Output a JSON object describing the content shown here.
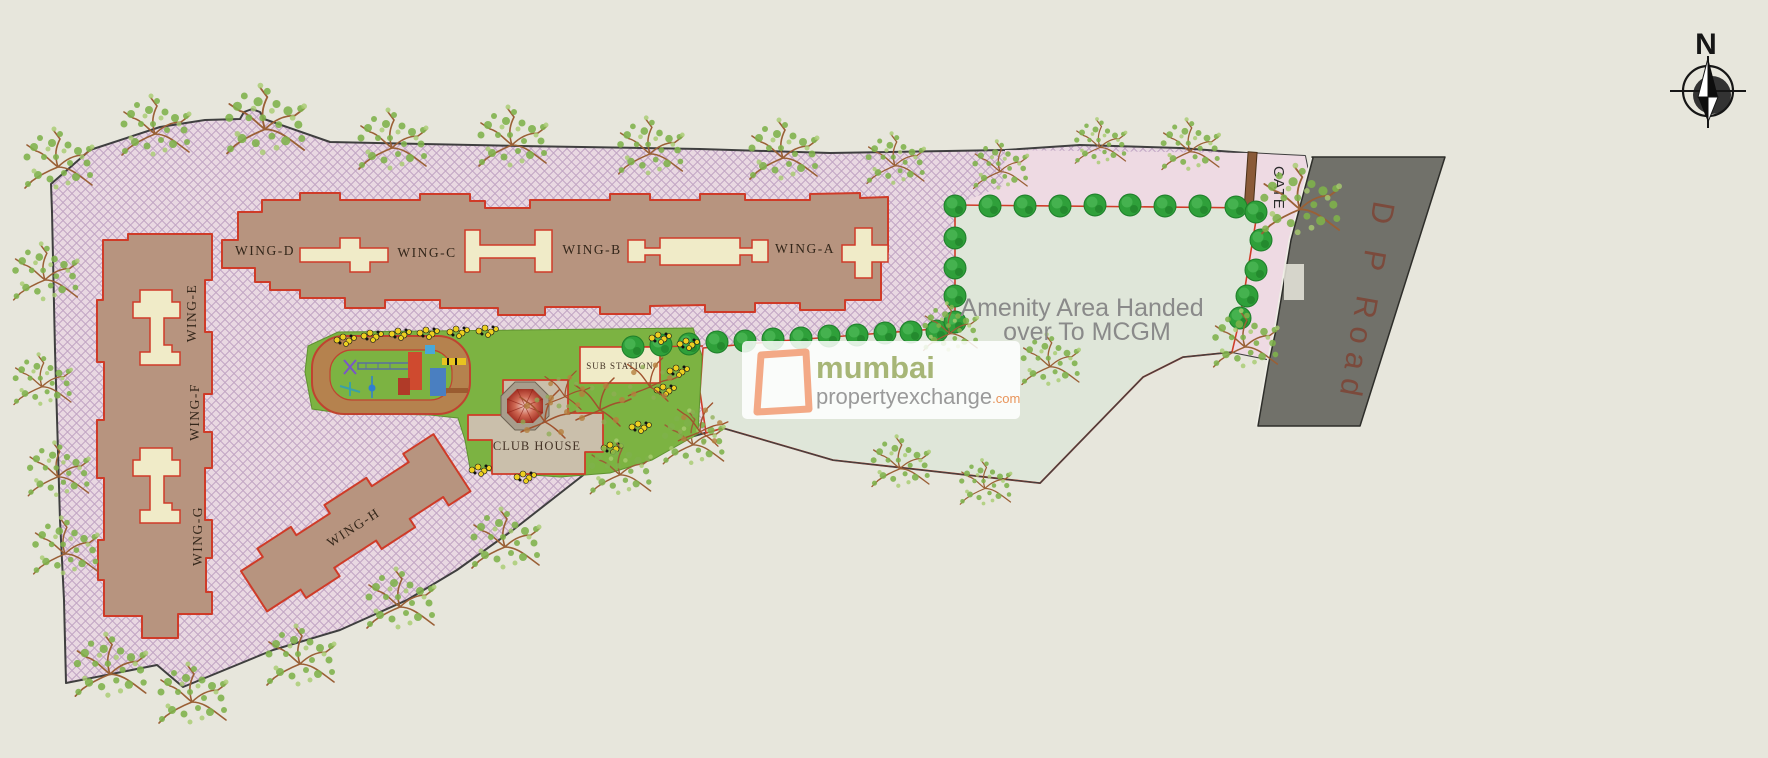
{
  "compass": {
    "north_label": "N"
  },
  "labels": {
    "wing_a": "WING-A",
    "wing_b": "WING-B",
    "wing_c": "WING-C",
    "wing_d": "WING-D",
    "wing_e": "WING-E",
    "wing_f": "WING-F",
    "wing_g": "WING-G",
    "wing_h": "WING-H",
    "club_house": "CLUB HOUSE",
    "sub_station": "SUB STATION",
    "gate": "GATE",
    "dp_road": "D P Road",
    "amenity_line1": "Amenity Area Handed",
    "amenity_line2": "over To MCGM"
  },
  "watermark": {
    "brand": "mumbai",
    "brand_secondary": "propertyexchange",
    "tld": ".com"
  },
  "colors": {
    "background_cream": "#e7e6dc",
    "site_pink": "#e9d8e2",
    "hatch_line": "#c2a6c4",
    "plain_pink": "#eedae3",
    "amenity_green": "#dfe6d9",
    "road_gray": "#71716a",
    "building_tan": "#b7947f",
    "outline_red": "#cf3b28",
    "core_cream": "#f0ebc8",
    "club_house_tan": "#cabfab",
    "lawn_green": "#7cb342",
    "bush_green": "#2fa03a",
    "track_brown": "#b5824e",
    "gate_brown": "#8a5a38",
    "road_text_brown": "#7b4a3c",
    "logo_olive": "#a7b677",
    "logo_gray": "#9a9a9a",
    "logo_orange": "#e8945a",
    "boundary_dark": "#3f3f3f"
  }
}
